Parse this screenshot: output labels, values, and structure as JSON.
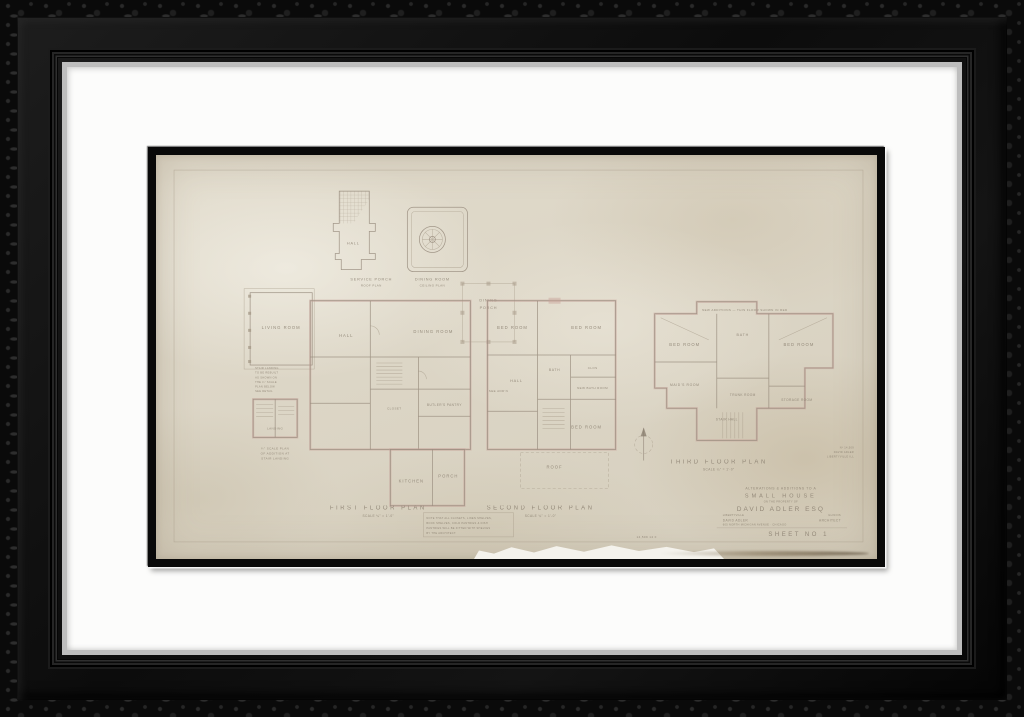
{
  "frame": {
    "outer_color": "#0a0a0a",
    "lip_color": "#bdbdbd",
    "mat_color": "#fcfcfb",
    "fillet_color": "#090909",
    "paper_color": "#ddd6c7",
    "line_color": "#978b7c",
    "wall_color": "#c7a29a"
  },
  "drawing": {
    "service": {
      "room": "HALL",
      "caption": "SERVICE PORCH",
      "subcaption": "ROOF PLAN"
    },
    "ceiling": {
      "caption": "DINING ROOM",
      "subcaption": "CEILING PLAN"
    },
    "dining_porch": {
      "line1": "DINING",
      "line2": "PORCH"
    },
    "first": {
      "caption": "FIRST FLOOR PLAN",
      "scale": "SCALE  ¼\" = 1'-0\"",
      "rooms": [
        "LIVING ROOM",
        "HALL",
        "DINING ROOM",
        "KITCHEN",
        "PORCH",
        "BUTLER'S PANTRY",
        "CLOSET"
      ]
    },
    "stair_plan": {
      "room": "LANDING",
      "caption1": "¼\" SCALE PLAN",
      "caption2": "OF ADDITION AT",
      "caption3": "STAIR LANDING",
      "note": [
        "STAIR LANDING",
        "TO BE REBUILT",
        "AS SHOWN ON",
        "THE ¼\" SCALE",
        "PLAN BELOW",
        "SEE DETAIL"
      ]
    },
    "notes_box": [
      "NOTE THAT ALL CLOSETS, LINEN SHELVES,",
      "BOOK SHELVES, COLD PANTRIES & DISH",
      "PANTRIES WILL BE FITTED WITH SHELVES",
      "BY THE ARCHITECT."
    ],
    "second": {
      "caption": "SECOND FLOOR PLAN",
      "scale": "SCALE  ¼\" = 1'-0\"",
      "rooms": [
        "BED ROOM",
        "BED ROOM",
        "HALL",
        "BATH",
        "CLOS",
        "NEW BATH ROOM",
        "BED ROOM",
        "SEE ADD'N",
        "ROOF"
      ]
    },
    "third": {
      "caption": "THIRD FLOOR PLAN",
      "scale": "SCALE  ¼\" = 1'-0\"",
      "annotation": "NEW ADDITIONS — THIS FLOOR SHOWN IN RED",
      "rooms": [
        "BED ROOM",
        "BATH",
        "BED ROOM",
        "MAID'S ROOM",
        "TRUNK ROOM",
        "STORAGE ROOM",
        "STAIR HALL"
      ]
    },
    "stamp": [
      "Nº 14,509",
      "DAVID ADLER",
      "LIBERTYVILLE ILL"
    ],
    "pencil_note": "14,509   14 F",
    "title_block": {
      "line1": "ALTERATIONS & ADDITIONS TO A",
      "line2": "SMALL HOUSE",
      "line3": "ON THE PROPERTY OF",
      "line4": "DAVID ADLER ESQ",
      "place_left": "LIBERTYVILLE",
      "place_right": "ILLINOIS",
      "arch_left": "DAVID ADLER",
      "arch_right": "ARCHITECT",
      "arch_addr": "605 NORTH MICHIGAN AVENUE · CHICAGO",
      "sheet": "SHEET NO 1"
    }
  }
}
